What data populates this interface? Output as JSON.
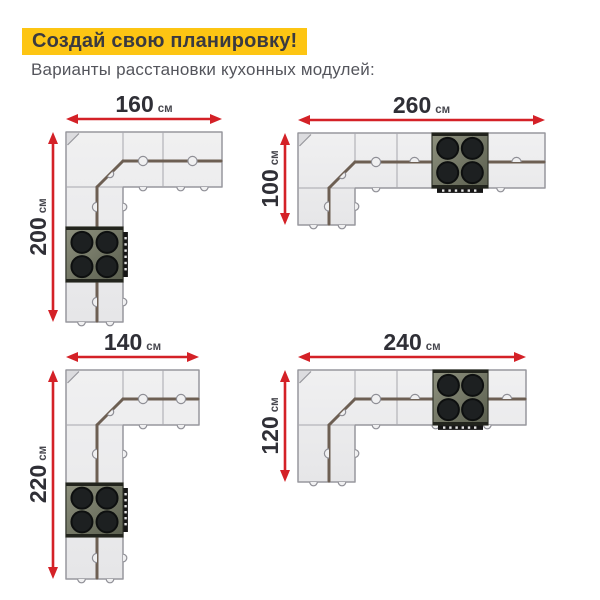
{
  "header": {
    "title": "Создай свою планировку!",
    "subtitle": "Варианты расстановки кухонных модулей:"
  },
  "colors": {
    "highlight_yellow": "#fdc513",
    "accent_red": "#d42127",
    "cabinet_fill_light": "#f0f0f1",
    "cabinet_fill_dark": "#e6e6e8",
    "cabinet_outline": "#97979d",
    "cabinet_division_line": "#a7a7ad",
    "counter_edge_brown": "#6d5f53",
    "handle_gray": "#8f8f96",
    "stove_body_light": "#8f927f",
    "stove_body_dark": "#5a5e4e",
    "stove_bar_dark": "#22241d",
    "burner_black": "#1d2021",
    "control_strip_black": "#161616",
    "knob_white": "#e6e6e6",
    "dimension_value_color": "#2f2f36",
    "dimension_unit_color": "#47474e",
    "title_text": "#3a3a40",
    "subtitle_text": "#54555c"
  },
  "layouts": [
    {
      "id": "layout-160x200",
      "width_label": "160",
      "height_label": "200",
      "unit": "см",
      "stove_burners": 4,
      "geom": {
        "w": 156,
        "h": 190,
        "rowADivs": [
          57,
          97
        ],
        "rowBDivs": [
          97
        ],
        "colDivs": [
          95,
          150
        ],
        "stove": {
          "arm": "v",
          "from": 95,
          "to": 150
        }
      }
    },
    {
      "id": "layout-260x100",
      "width_label": "260",
      "height_label": "100",
      "unit": "см",
      "stove_burners": 4,
      "geom": {
        "w": 247,
        "h": 92,
        "rowADivs": [
          57,
          99,
          134,
          190
        ],
        "rowBDivs": [
          99
        ],
        "colDivs": [],
        "stove": {
          "arm": "h",
          "from": 134,
          "to": 190
        }
      }
    },
    {
      "id": "layout-140x220",
      "width_label": "140",
      "height_label": "220",
      "unit": "см",
      "stove_burners": 4,
      "geom": {
        "w": 133,
        "h": 209,
        "rowADivs": [
          57,
          97
        ],
        "rowBDivs": [
          97
        ],
        "colDivs": [
          113,
          167
        ],
        "stove": {
          "arm": "v",
          "from": 113,
          "to": 167
        }
      }
    },
    {
      "id": "layout-240x120",
      "width_label": "240",
      "height_label": "120",
      "unit": "см",
      "stove_burners": 4,
      "geom": {
        "w": 228,
        "h": 112,
        "rowADivs": [
          57,
          99,
          135,
          190
        ],
        "rowBDivs": [
          99
        ],
        "colDivs": [],
        "stove": {
          "arm": "h",
          "from": 135,
          "to": 190
        }
      }
    }
  ]
}
